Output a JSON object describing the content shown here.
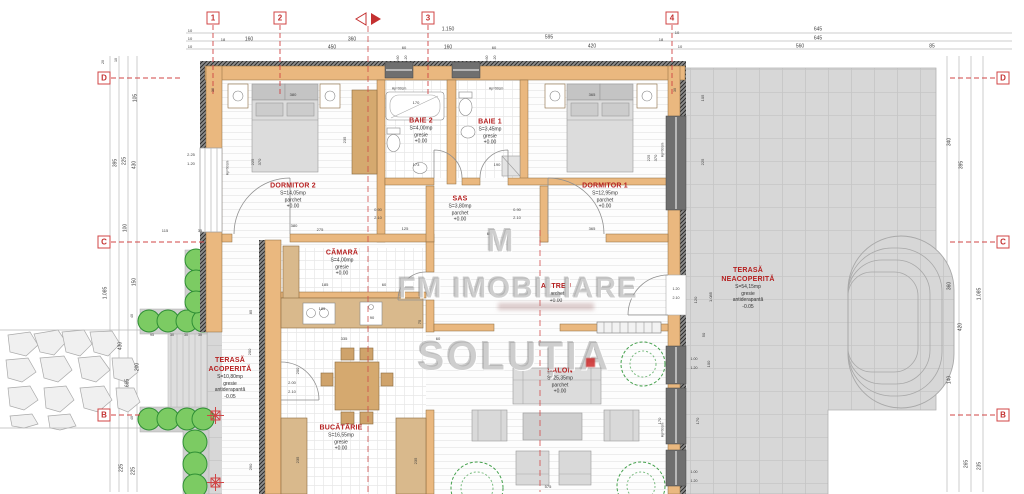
{
  "watermark": {
    "logo": "M",
    "brand": "FM IMOBILIARE",
    "brand2": "SOLUȚIA"
  },
  "colors": {
    "wall": "#eab87f",
    "terrace": "#d7d7d7",
    "label_red": "#b51f1f",
    "grid_red": "#d04545",
    "hedge_green": "#7ccb63",
    "dim_text": "#3c3c3c"
  },
  "grid": {
    "columns": [
      {
        "label": "1",
        "x": 213
      },
      {
        "label": "2",
        "x": 280
      },
      {
        "label": "3",
        "x": 428
      },
      {
        "label": "4",
        "x": 672
      }
    ],
    "rows": [
      {
        "label": "D",
        "y": 78
      },
      {
        "label": "C",
        "y": 242
      },
      {
        "label": "B",
        "y": 415
      }
    ]
  },
  "rooms": [
    {
      "id": "dormitor-2",
      "name": "DORMITOR 2",
      "area": "S=14,05mp",
      "finish": "parchet",
      "extra": "",
      "level": "+0.00",
      "x": 293,
      "y": 196
    },
    {
      "id": "baie-2",
      "name": "BAIE 2",
      "area": "S=4,00mp",
      "finish": "gresie",
      "extra": "",
      "level": "+0.00",
      "x": 421,
      "y": 131
    },
    {
      "id": "baie-1",
      "name": "BAIE 1",
      "area": "S=3,45mp",
      "finish": "gresie",
      "extra": "",
      "level": "+0.00",
      "x": 490,
      "y": 132
    },
    {
      "id": "dormitor-1",
      "name": "DORMITOR 1",
      "area": "S=12,95mp",
      "finish": "parchet",
      "extra": "",
      "level": "+0.00",
      "x": 605,
      "y": 196
    },
    {
      "id": "sas",
      "name": "SAS",
      "area": "S=3,80mp",
      "finish": "parchet",
      "extra": "",
      "level": "+0.00",
      "x": 460,
      "y": 209
    },
    {
      "id": "camara",
      "name": "CĂMARĂ",
      "area": "S=4,00mp",
      "finish": "gresie",
      "extra": "",
      "level": "+0.00",
      "x": 342,
      "y": 263
    },
    {
      "id": "antreu",
      "name": "ANTREU",
      "area": "",
      "finish": "parchet",
      "extra": "",
      "level": "+0.00",
      "x": 556,
      "y": 293
    },
    {
      "id": "terasa-neacoperita",
      "name": "TERASĂ NEACOPERITĂ",
      "area": "S=54,15mp",
      "finish": "gresie",
      "extra": "antiderapantă",
      "level": "-0.05",
      "w": 74,
      "x": 748,
      "y": 288
    },
    {
      "id": "terasa-acoperita",
      "name": "TERASĂ ACOPERITĂ",
      "area": "S=10,80mp",
      "finish": "gresie",
      "extra": "antiderapantă",
      "level": "-0.05",
      "w": 66,
      "x": 230,
      "y": 378
    },
    {
      "id": "bucatarie",
      "name": "BUCĂTĂRIE",
      "area": "S=16,55mp",
      "finish": "gresie",
      "extra": "",
      "level": "+0.00",
      "x": 341,
      "y": 438
    },
    {
      "id": "salon",
      "name": "SALON",
      "area": "S=25,35mp",
      "finish": "parchet",
      "extra": "",
      "level": "+0.00",
      "x": 560,
      "y": 381
    }
  ],
  "dims": [
    {
      "t": "1.150",
      "x": 448,
      "y": 30
    },
    {
      "t": "645",
      "x": 818,
      "y": 30
    },
    {
      "t": "10",
      "x": 190,
      "y": 31,
      "s": 4
    },
    {
      "t": "10",
      "x": 190,
      "y": 39,
      "s": 4
    },
    {
      "t": "10",
      "x": 190,
      "y": 47,
      "s": 4
    },
    {
      "t": "18",
      "x": 223,
      "y": 40,
      "s": 4
    },
    {
      "t": "160",
      "x": 249,
      "y": 40
    },
    {
      "t": "360",
      "x": 352,
      "y": 40
    },
    {
      "t": "595",
      "x": 549,
      "y": 38
    },
    {
      "t": "645",
      "x": 818,
      "y": 39
    },
    {
      "t": "450",
      "x": 332,
      "y": 48
    },
    {
      "t": "60",
      "x": 404,
      "y": 48,
      "s": 4
    },
    {
      "t": "160",
      "x": 448,
      "y": 48
    },
    {
      "t": "60",
      "x": 494,
      "y": 48,
      "s": 4
    },
    {
      "t": "420",
      "x": 592,
      "y": 47
    },
    {
      "t": "18",
      "x": 661,
      "y": 40,
      "s": 4
    },
    {
      "t": "10",
      "x": 677,
      "y": 33,
      "s": 4
    },
    {
      "t": "10",
      "x": 680,
      "y": 47,
      "s": 4
    },
    {
      "t": "560",
      "x": 800,
      "y": 47
    },
    {
      "t": "85",
      "x": 932,
      "y": 47
    },
    {
      "t": "0.60",
      "x": 399,
      "y": 59,
      "r": -90,
      "s": 3.6
    },
    {
      "t": "1.20",
      "x": 407,
      "y": 59,
      "r": -90,
      "s": 3.6
    },
    {
      "t": "0.60",
      "x": 488,
      "y": 59,
      "r": -90,
      "s": 3.6
    },
    {
      "t": "1.20",
      "x": 496,
      "y": 59,
      "r": -90,
      "s": 3.6
    },
    {
      "t": "20",
      "x": 104,
      "y": 62,
      "r": -90,
      "s": 3.6
    },
    {
      "t": "10",
      "x": 117,
      "y": 60,
      "r": -90,
      "s": 3.6
    },
    {
      "t": "105",
      "x": 136,
      "y": 98,
      "r": -90
    },
    {
      "t": "395",
      "x": 116,
      "y": 163,
      "r": -90
    },
    {
      "t": "225",
      "x": 125,
      "y": 161,
      "r": -90
    },
    {
      "t": "430",
      "x": 135,
      "y": 165,
      "r": -90
    },
    {
      "t": "100",
      "x": 126,
      "y": 228,
      "r": -90
    },
    {
      "t": "115",
      "x": 165,
      "y": 231,
      "s": 4
    },
    {
      "t": "35",
      "x": 200,
      "y": 231,
      "s": 4
    },
    {
      "t": "150",
      "x": 135,
      "y": 282,
      "r": -90
    },
    {
      "t": "1.085",
      "x": 106,
      "y": 293,
      "r": -90
    },
    {
      "t": "40",
      "x": 133,
      "y": 316,
      "r": -90,
      "s": 3.6
    },
    {
      "t": "95",
      "x": 152,
      "y": 336,
      "s": 3.6
    },
    {
      "t": "30",
      "x": 172,
      "y": 336,
      "s": 3.6
    },
    {
      "t": "30",
      "x": 186,
      "y": 336,
      "s": 3.6
    },
    {
      "t": "30",
      "x": 200,
      "y": 336,
      "s": 3.6
    },
    {
      "t": "430",
      "x": 121,
      "y": 346,
      "r": -90
    },
    {
      "t": "200",
      "x": 138,
      "y": 367,
      "r": -90
    },
    {
      "t": "665",
      "x": 128,
      "y": 383,
      "r": -90
    },
    {
      "t": "40",
      "x": 133,
      "y": 418,
      "r": -90,
      "s": 3.6
    },
    {
      "t": "225",
      "x": 122,
      "y": 468,
      "r": -90
    },
    {
      "t": "225",
      "x": 134,
      "y": 471,
      "r": -90
    },
    {
      "t": "340",
      "x": 950,
      "y": 142,
      "r": -90
    },
    {
      "t": "395",
      "x": 962,
      "y": 165,
      "r": -90
    },
    {
      "t": "360",
      "x": 950,
      "y": 286,
      "r": -90
    },
    {
      "t": "1.085",
      "x": 980,
      "y": 294,
      "r": -90
    },
    {
      "t": "420",
      "x": 961,
      "y": 327,
      "r": -90
    },
    {
      "t": "140",
      "x": 950,
      "y": 380,
      "r": -90
    },
    {
      "t": "265",
      "x": 967,
      "y": 464,
      "r": -90
    },
    {
      "t": "235",
      "x": 980,
      "y": 466,
      "r": -90
    },
    {
      "t": "380",
      "x": 293,
      "y": 95,
      "s": 4
    },
    {
      "t": "365",
      "x": 592,
      "y": 95,
      "s": 4
    },
    {
      "t": "Hp=90cm",
      "x": 399,
      "y": 89,
      "s": 3.4
    },
    {
      "t": "Hp=90cm",
      "x": 496,
      "y": 89,
      "s": 3.4
    },
    {
      "t": "170",
      "x": 416,
      "y": 103,
      "s": 4
    },
    {
      "t": "2.25",
      "x": 191,
      "y": 155,
      "s": 4
    },
    {
      "t": "1.20",
      "x": 191,
      "y": 164,
      "s": 4
    },
    {
      "t": "Hp=90cm",
      "x": 228,
      "y": 168,
      "r": -90,
      "s": 3.4
    },
    {
      "t": "225",
      "x": 253,
      "y": 162,
      "r": -90,
      "s": 4
    },
    {
      "t": "370",
      "x": 260,
      "y": 162,
      "r": -90,
      "s": 4
    },
    {
      "t": "235",
      "x": 345,
      "y": 140,
      "r": -90,
      "s": 4
    },
    {
      "t": "225",
      "x": 649,
      "y": 158,
      "r": -90,
      "s": 4
    },
    {
      "t": "370",
      "x": 656,
      "y": 158,
      "r": -90,
      "s": 4
    },
    {
      "t": "Hp=90cm",
      "x": 663,
      "y": 150,
      "r": -90,
      "s": 3.4
    },
    {
      "t": "173",
      "x": 416,
      "y": 165,
      "s": 4
    },
    {
      "t": "190",
      "x": 497,
      "y": 165,
      "s": 4
    },
    {
      "t": "0.90",
      "x": 378,
      "y": 210,
      "s": 4
    },
    {
      "t": "2.10",
      "x": 378,
      "y": 218,
      "s": 4
    },
    {
      "t": "0.90",
      "x": 517,
      "y": 210,
      "s": 4
    },
    {
      "t": "2.10",
      "x": 517,
      "y": 218,
      "s": 4
    },
    {
      "t": "380",
      "x": 294,
      "y": 226,
      "s": 4
    },
    {
      "t": "275",
      "x": 320,
      "y": 230,
      "s": 4
    },
    {
      "t": "125",
      "x": 405,
      "y": 229,
      "s": 4
    },
    {
      "t": "365",
      "x": 592,
      "y": 229,
      "s": 4
    },
    {
      "t": "65",
      "x": 489,
      "y": 234,
      "s": 4
    },
    {
      "t": "30",
      "x": 214,
      "y": 90,
      "r": -90,
      "s": 3.6
    },
    {
      "t": "30",
      "x": 676,
      "y": 90,
      "r": -90,
      "s": 3.6
    },
    {
      "t": "185",
      "x": 325,
      "y": 285,
      "s": 4
    },
    {
      "t": "60",
      "x": 384,
      "y": 285,
      "s": 4
    },
    {
      "t": "185",
      "x": 322,
      "y": 309,
      "s": 4
    },
    {
      "t": "90",
      "x": 372,
      "y": 318,
      "s": 4
    },
    {
      "t": "335",
      "x": 344,
      "y": 339,
      "s": 4
    },
    {
      "t": "60",
      "x": 438,
      "y": 339,
      "s": 4
    },
    {
      "t": "75",
      "x": 420,
      "y": 322,
      "r": -90,
      "s": 4
    },
    {
      "t": "105",
      "x": 703,
      "y": 98,
      "r": -90,
      "s": 4
    },
    {
      "t": "225",
      "x": 703,
      "y": 162,
      "r": -90,
      "s": 4
    },
    {
      "t": "120",
      "x": 696,
      "y": 300,
      "r": -90,
      "s": 4
    },
    {
      "t": "1.085",
      "x": 711,
      "y": 297,
      "r": -90,
      "s": 4
    },
    {
      "t": "50",
      "x": 704,
      "y": 335,
      "r": -90,
      "s": 4
    },
    {
      "t": "100",
      "x": 709,
      "y": 364,
      "r": -90,
      "s": 4
    },
    {
      "t": "1.00",
      "x": 694,
      "y": 360,
      "s": 3.6
    },
    {
      "t": "1.20",
      "x": 694,
      "y": 369,
      "s": 3.6
    },
    {
      "t": "1.00",
      "x": 694,
      "y": 473,
      "s": 3.6
    },
    {
      "t": "1.20",
      "x": 694,
      "y": 482,
      "s": 3.6
    },
    {
      "t": "1.20",
      "x": 676,
      "y": 290,
      "s": 3.6
    },
    {
      "t": "2.10",
      "x": 676,
      "y": 299,
      "s": 3.6
    },
    {
      "t": "2.00",
      "x": 292,
      "y": 383,
      "s": 4
    },
    {
      "t": "2.10",
      "x": 292,
      "y": 392,
      "s": 4
    },
    {
      "t": "200",
      "x": 298,
      "y": 371,
      "r": -90,
      "s": 4
    },
    {
      "t": "85",
      "x": 251,
      "y": 312,
      "r": -90,
      "s": 4
    },
    {
      "t": "200",
      "x": 250,
      "y": 352,
      "r": -90,
      "s": 4
    },
    {
      "t": "290",
      "x": 251,
      "y": 467,
      "r": -90,
      "s": 4
    },
    {
      "t": "235",
      "x": 298,
      "y": 460,
      "r": -90,
      "s": 4
    },
    {
      "t": "235",
      "x": 416,
      "y": 461,
      "r": -90,
      "s": 4
    },
    {
      "t": "575",
      "x": 548,
      "y": 487,
      "s": 4
    },
    {
      "t": "170",
      "x": 660,
      "y": 421,
      "r": -90,
      "s": 4
    },
    {
      "t": "170",
      "x": 698,
      "y": 421,
      "r": -90,
      "s": 4
    },
    {
      "t": "Hp=90cm",
      "x": 663,
      "y": 430,
      "r": -90,
      "s": 3.4
    }
  ]
}
